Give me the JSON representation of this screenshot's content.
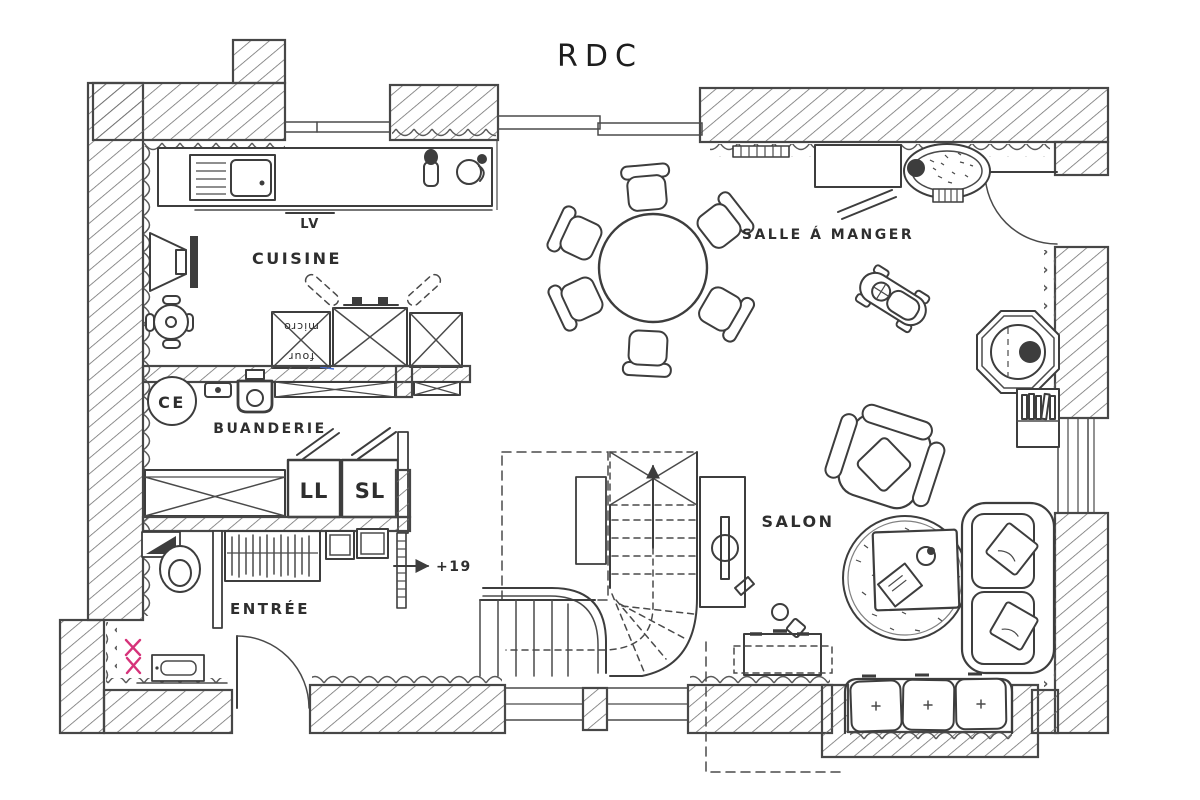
{
  "title": "RDC",
  "labels": {
    "cuisine": "CUISINE",
    "lave_vaisselle": "LV",
    "micro": "micro",
    "four": "four",
    "chauffe_eau": "CE",
    "buanderie": "BUANDERIE",
    "lave_linge": "LL",
    "seche_linge": "SL",
    "entree": "ENTRÉE",
    "step_height": "+19",
    "salle_a_manger": "SALLE Á MANGER",
    "salon": "SALON"
  },
  "colors": {
    "ink": "#3d3d3d",
    "paper": "#ffffff",
    "accent_pink": "#d6337a",
    "accent_blue": "#4a6fd4"
  }
}
